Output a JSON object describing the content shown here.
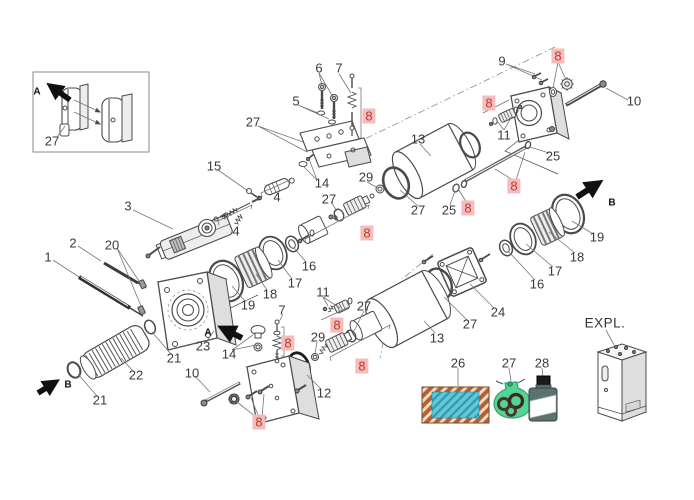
{
  "meta": {
    "kind": "exploded-parts-diagram",
    "view_code": "EXPL."
  },
  "colors": {
    "label_text": "#3a3a3a",
    "highlight_bg": "#f5bcbc",
    "highlight_text": "#c0392b",
    "line": "#4a4a4a",
    "legend_seal_outer": "#b5602f",
    "legend_seal_inner": "#62c8d8",
    "legend_bag": "#45d08d",
    "legend_bottle": "#5c7270"
  },
  "inset": {
    "part_label": "27",
    "direction_letter": "A"
  },
  "expl_label": "EXPL.",
  "arrows": [
    {
      "letter": "A",
      "x": 37,
      "y": 92
    },
    {
      "letter": "A",
      "x": 208,
      "y": 333
    },
    {
      "letter": "B",
      "x": 612,
      "y": 203
    },
    {
      "letter": "B",
      "x": 68,
      "y": 385
    }
  ],
  "labels": [
    {
      "text": "27",
      "x": 52,
      "y": 141
    },
    {
      "text": "6",
      "x": 319,
      "y": 68
    },
    {
      "text": "7",
      "x": 339,
      "y": 68
    },
    {
      "text": "5",
      "x": 296,
      "y": 101
    },
    {
      "text": "27",
      "x": 253,
      "y": 122
    },
    {
      "text": "8",
      "x": 369,
      "y": 116,
      "hl": true
    },
    {
      "text": "9",
      "x": 502,
      "y": 61
    },
    {
      "text": "8",
      "x": 558,
      "y": 56,
      "hl": true
    },
    {
      "text": "10",
      "x": 634,
      "y": 101
    },
    {
      "text": "8",
      "x": 489,
      "y": 103,
      "hl": true
    },
    {
      "text": "11",
      "x": 504,
      "y": 135
    },
    {
      "text": "25",
      "x": 553,
      "y": 156
    },
    {
      "text": "13",
      "x": 418,
      "y": 139
    },
    {
      "text": "15",
      "x": 214,
      "y": 166
    },
    {
      "text": "29",
      "x": 366,
      "y": 177
    },
    {
      "text": "14",
      "x": 322,
      "y": 183
    },
    {
      "text": "8",
      "x": 514,
      "y": 186,
      "hl": true
    },
    {
      "text": "4",
      "x": 277,
      "y": 197
    },
    {
      "text": "27",
      "x": 329,
      "y": 199
    },
    {
      "text": "3",
      "x": 128,
      "y": 206
    },
    {
      "text": "8",
      "x": 468,
      "y": 208,
      "hl": true
    },
    {
      "text": "25",
      "x": 449,
      "y": 210
    },
    {
      "text": "27",
      "x": 418,
      "y": 210
    },
    {
      "text": "4",
      "x": 236,
      "y": 231
    },
    {
      "text": "8",
      "x": 367,
      "y": 233,
      "hl": true
    },
    {
      "text": "19",
      "x": 597,
      "y": 237
    },
    {
      "text": "1",
      "x": 48,
      "y": 257
    },
    {
      "text": "2",
      "x": 73,
      "y": 243
    },
    {
      "text": "20",
      "x": 112,
      "y": 245
    },
    {
      "text": "18",
      "x": 577,
      "y": 257
    },
    {
      "text": "16",
      "x": 309,
      "y": 266
    },
    {
      "text": "17",
      "x": 555,
      "y": 271
    },
    {
      "text": "17",
      "x": 295,
      "y": 283
    },
    {
      "text": "16",
      "x": 537,
      "y": 284
    },
    {
      "text": "11",
      "x": 323,
      "y": 292
    },
    {
      "text": "18",
      "x": 270,
      "y": 294
    },
    {
      "text": "19",
      "x": 248,
      "y": 305
    },
    {
      "text": "27",
      "x": 364,
      "y": 306
    },
    {
      "text": "7",
      "x": 282,
      "y": 310
    },
    {
      "text": "24",
      "x": 498,
      "y": 312
    },
    {
      "text": "27",
      "x": 470,
      "y": 324
    },
    {
      "text": "8",
      "x": 337,
      "y": 325,
      "hl": true
    },
    {
      "text": "29",
      "x": 318,
      "y": 337
    },
    {
      "text": "13",
      "x": 437,
      "y": 338
    },
    {
      "text": "8",
      "x": 288,
      "y": 343,
      "hl": true
    },
    {
      "text": "23",
      "x": 203,
      "y": 346
    },
    {
      "text": "14",
      "x": 229,
      "y": 354
    },
    {
      "text": "21",
      "x": 174,
      "y": 358
    },
    {
      "text": "26",
      "x": 458,
      "y": 363
    },
    {
      "text": "27",
      "x": 509,
      "y": 363
    },
    {
      "text": "28",
      "x": 542,
      "y": 363
    },
    {
      "text": "8",
      "x": 362,
      "y": 366,
      "hl": true
    },
    {
      "text": "10",
      "x": 192,
      "y": 373
    },
    {
      "text": "22",
      "x": 136,
      "y": 375
    },
    {
      "text": "12",
      "x": 324,
      "y": 393
    },
    {
      "text": "21",
      "x": 100,
      "y": 400
    },
    {
      "text": "8",
      "x": 259,
      "y": 422,
      "hl": true
    },
    {
      "text": "EXPL.",
      "x": 605,
      "y": 323,
      "cls": "expl"
    }
  ],
  "legend": {
    "items": [
      {
        "number": "26",
        "icon": "seal-sheet-icon"
      },
      {
        "number": "27",
        "icon": "o-ring-bag-icon"
      },
      {
        "number": "28",
        "icon": "oil-bottle-icon"
      }
    ]
  }
}
